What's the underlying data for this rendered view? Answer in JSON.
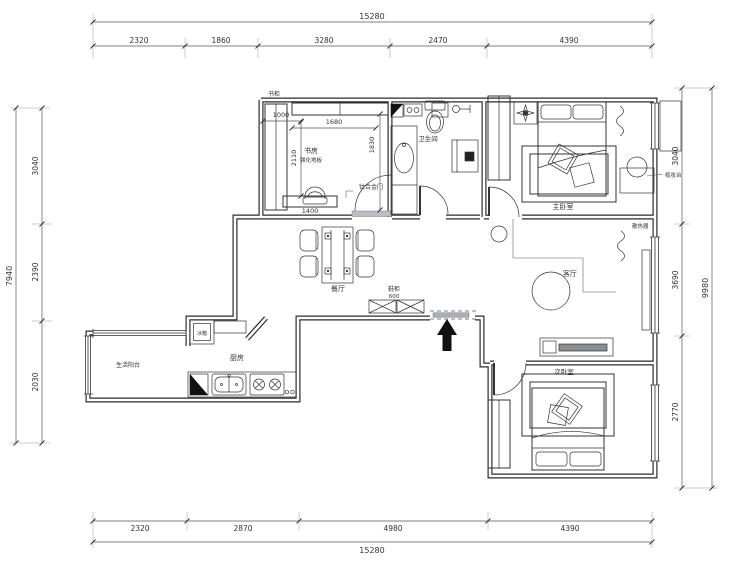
{
  "dims": {
    "top": {
      "overall": "15280",
      "segments": [
        "2320",
        "1860",
        "3280",
        "2470",
        "4390"
      ]
    },
    "bottom": {
      "overall": "15280",
      "segments": [
        "2320",
        "2870",
        "4980",
        "4390"
      ]
    },
    "left": {
      "overall": "7940",
      "segments": [
        "3040",
        "2390",
        "2030"
      ]
    },
    "right": {
      "overall": "9980",
      "segments": [
        "3040",
        "3690",
        "2770"
      ]
    }
  },
  "interior_dims": {
    "bookshelf_width": "1000",
    "closet_width": "1680",
    "closet_depth": "1830",
    "study_depth": "2110",
    "desk_width": "1400"
  },
  "rooms": {
    "study": "书房",
    "study_floor": "强化地板",
    "bathroom": "卫生间",
    "master_bedroom": "主卧室",
    "dining": "餐厅",
    "living": "客厅",
    "kitchen": "厨房",
    "balcony": "生活阳台",
    "second_bedroom": "次卧室"
  },
  "labels": {
    "bookcase": "书柜",
    "bathroom_door": "钛合金门",
    "shoe_cabinet": "鞋柜",
    "shoe_cabinet_size": "600",
    "fridge": "冰箱",
    "dresser": "梳妆台",
    "radiator": "散热器"
  },
  "colors": {
    "ink": "#2b2b2b",
    "dim_line": "#555",
    "entry_arrow": "#111111"
  }
}
